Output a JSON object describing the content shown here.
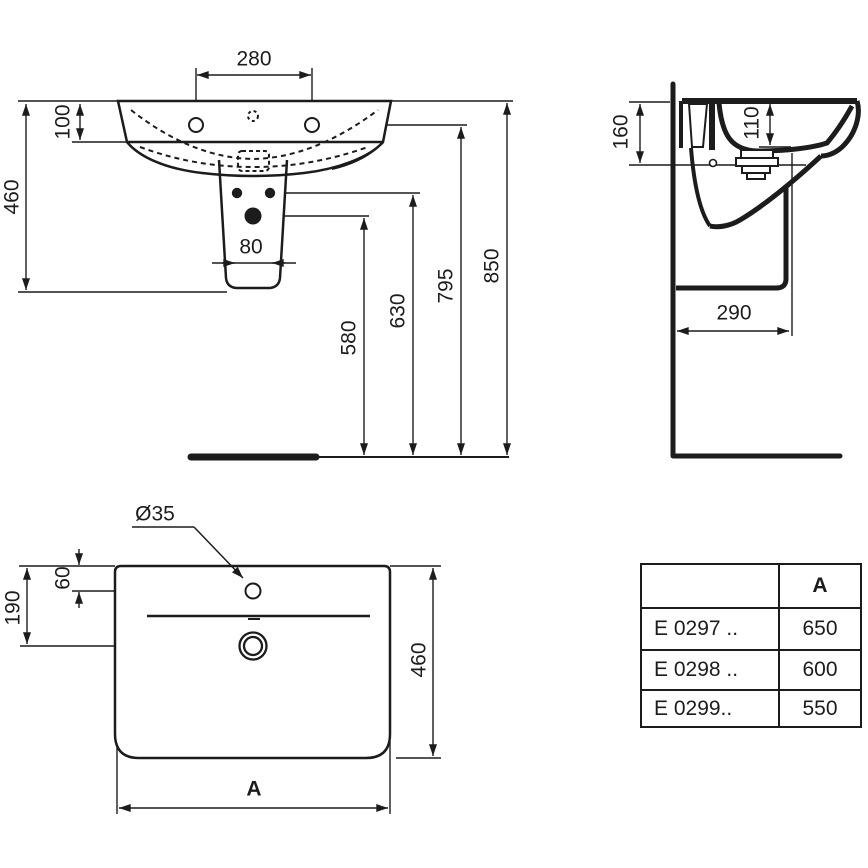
{
  "drawing_title": "washbasin-with-semi-pedestal-technical-drawing",
  "front_view": {
    "tap_hole_spacing": "280",
    "apron_height": "100",
    "basin_to_pedestal_height": "460",
    "bolt_hole_spacing": "80",
    "big_hole_height": "580",
    "small_holes_height": "630",
    "tap_hole_height": "795",
    "rim_height": "850"
  },
  "side_view": {
    "front_edge_height": "160",
    "bowl_depth": "110",
    "pedestal_depth": "290"
  },
  "top_view": {
    "tap_hole_diameter": "Ø35",
    "tap_hole_offset": "60",
    "drain_offset": "190",
    "basin_depth": "460",
    "width_label": "A"
  },
  "table": {
    "header": [
      "",
      "A"
    ],
    "rows": [
      [
        "E 0297 ..",
        "650"
      ],
      [
        "E 0298 ..",
        "600"
      ],
      [
        "E 0299..",
        "550"
      ]
    ]
  },
  "colors": {
    "ink": "#1c1c1c",
    "background": "#ffffff"
  }
}
